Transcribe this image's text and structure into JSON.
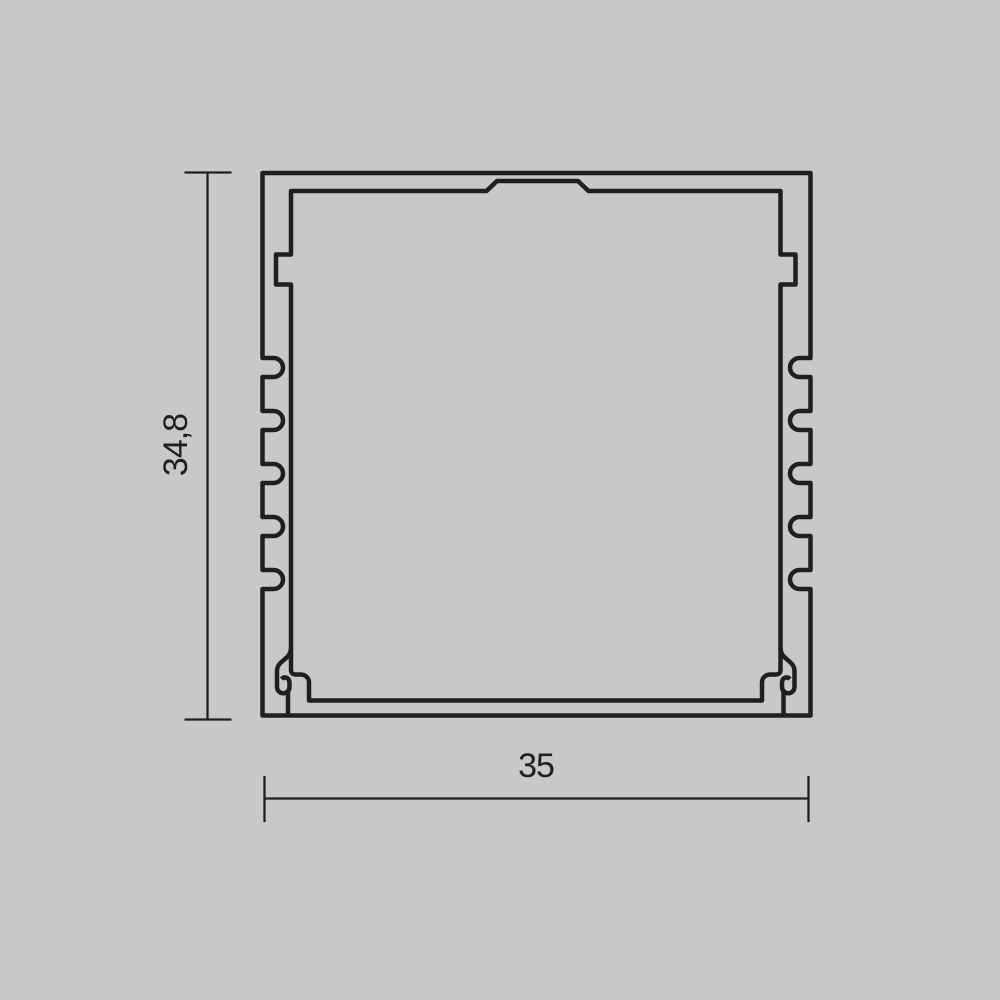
{
  "drawing": {
    "type": "profile-cross-section-technical-drawing",
    "background_color": "#c8c8c8",
    "line_color": "#1f1f1f",
    "dimensions": {
      "height": {
        "label": "34,8",
        "orientation": "vertical"
      },
      "width": {
        "label": "35",
        "orientation": "horizontal"
      }
    }
  }
}
